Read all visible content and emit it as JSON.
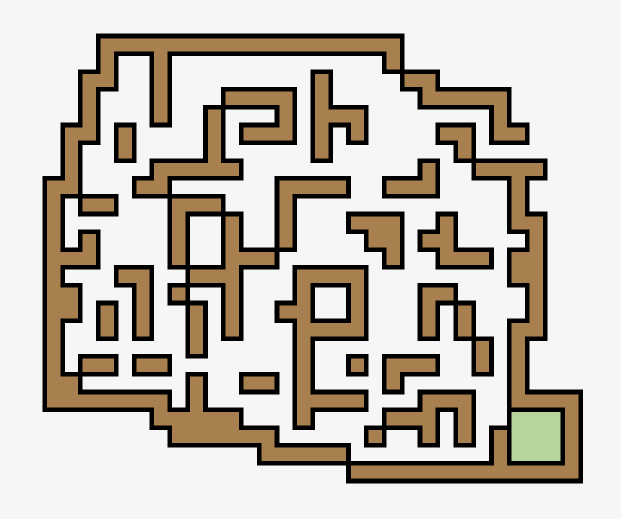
{
  "window": {
    "width": 621,
    "height": 519,
    "background": "#f6f6f6"
  },
  "maze": {
    "cols": 31,
    "rows": 25,
    "origin_x": 44.7,
    "origin_y": 36.0,
    "cell_w": 17.87,
    "cell_h": 17.8,
    "wall_color": "#a87f4f",
    "goal_color": "#b6d49c",
    "outline_color": "#000000",
    "outline_width": 4.6,
    "legend": {
      "wall": "#",
      "empty": ".",
      "goal": "G"
    },
    "grid": [
      "...#################...........",
      "...#..#............#...........",
      "..##..#........#....##.........",
      "..#...#...####.#.....#####.....",
      "..#...#..#...#.###.......#.....",
      ".##.#....#.###.#.#....##.##....",
      ".#..#....#.....#.......#.......",
      ".#....#####..........#..####...",
      "##...##......####..###....#....",
      "#.##...###...#............#....",
      "#......#..#..#...###..#...##...",
      "#.#....#..#..#....##.##....#...",
      "###....#..###......#..###.##...",
      "#...##..###...####........##...",
      "##...#.#..#...#..#...##....#...",
      "##.#.#..#.#..##..#...#.#...#...",
      "#..#.#..#.#...####...#.#..##...",
      "#.......#.....#.........#.#....",
      "#.##.##.......#..#.###..#.#....",
      "##......#..##.#....#......#....",
      "#######.#.....####...###..####.",
      "......#####...#....###.#..GGG#.",
      ".......######.....#..#.#.#GGG#.",
      "............#####........#GGG#.",
      ".................#############."
    ]
  }
}
